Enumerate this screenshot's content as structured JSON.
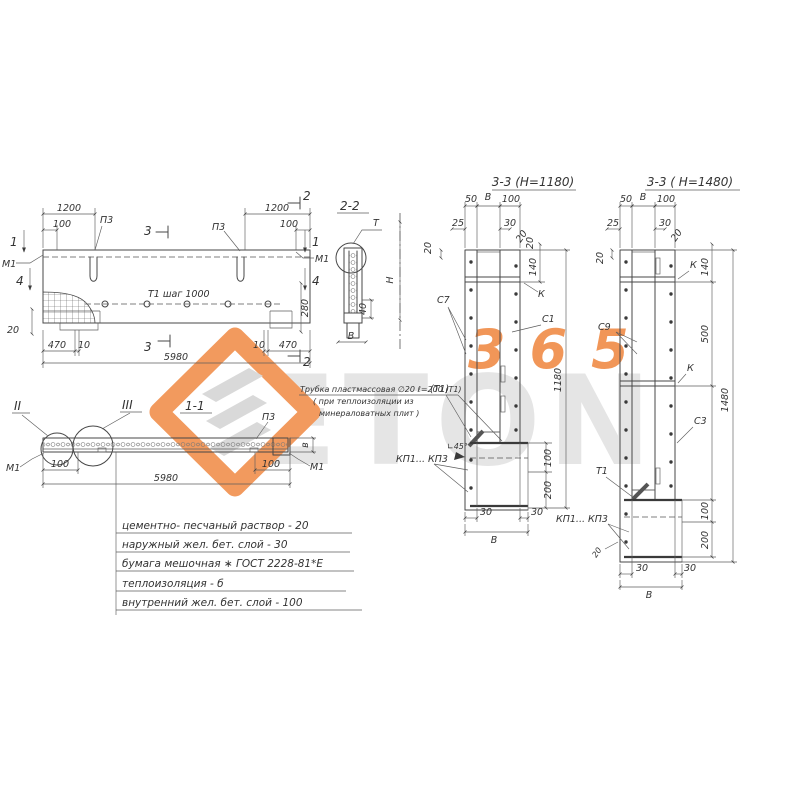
{
  "watermark": {
    "brand": "ETON",
    "number": "365",
    "accent": "#ee8034",
    "light_gray": "#e4e4e4"
  },
  "plan": {
    "dim_1200_left": "1200",
    "dim_100_left": "100",
    "label_p3_left": "П3",
    "mark_3_top": "3",
    "dim_1200_right": "1200",
    "dim_100_right": "100",
    "label_p3_right": "П3",
    "mark_2_top": "2",
    "mark_1_left": "1",
    "mark_4_left": "4",
    "label_m1_left": "М1",
    "mark_1_right": "1",
    "mark_4_right": "4",
    "label_m1_right": "М1",
    "row_note": "Т1  шаг 1000",
    "dim_20": "20",
    "dim_280": "280",
    "dim_470_left": "470",
    "dim_10_left": "10",
    "dim_10_right": "10",
    "dim_470_right": "470",
    "dim_5980": "5980",
    "mark_3_bottom": "3",
    "mark_2_bottom": "2"
  },
  "section_2_2": {
    "title": "2-2",
    "mark_t": "Т",
    "dim_h": "Н",
    "dim_40": "40",
    "dim_b": "В"
  },
  "section_1_1": {
    "title": "1-1",
    "detail_2": "II",
    "detail_3": "III",
    "label_p3": "П3",
    "label_m1_left": "М1",
    "label_m1_right": "М1",
    "dim_100_left": "100",
    "dim_100_right": "100",
    "dim_5980": "5980",
    "dim_b": "в"
  },
  "tube_note": {
    "line_1": "Трубка пластмассовая ∅20 ℓ=200 (Т1)",
    "line_2": "( при теплоизоляции из",
    "line_3": "минераловатных плит )"
  },
  "section_3_3_1180": {
    "title": "3-3 (Н=1180)",
    "dim_50": "50",
    "dim_b_top": "В",
    "dim_100_top": "100",
    "dim_25": "25",
    "dim_30_top": "30",
    "dim_20_angle": "20",
    "dim_20_left": "20",
    "dim_20_right": "20",
    "dim_140": "140",
    "label_c7": "С7",
    "label_c1": "С1",
    "label_k": "К",
    "label_t1": "(Т1)",
    "label_angle": "∟45°",
    "label_kp": "КП1... КП3",
    "dim_100_bottom": "100",
    "dim_200": "200",
    "dim_total": "1180",
    "dim_30_bl": "30",
    "dim_30_br": "30",
    "dim_b_bottom": "В"
  },
  "section_3_3_1480": {
    "title": "3-3 ( Н=1480)",
    "dim_50": "50",
    "dim_b_top": "В",
    "dim_100_top": "100",
    "dim_25": "25",
    "dim_30_top": "30",
    "dim_20_angle": "20",
    "dim_20_left": "20",
    "dim_140": "140",
    "dim_500": "500",
    "label_k1": "К",
    "label_k2": "К",
    "label_c9": "С9",
    "label_c3": "С3",
    "label_t1": "Т1",
    "label_kp": "КП1... КП3",
    "dim_20_corner": "20",
    "dim_100_bottom": "100",
    "dim_200": "200",
    "dim_total": "1480",
    "dim_30_bl": "30",
    "dim_30_br": "30",
    "dim_b_bottom": "В"
  },
  "layer_notes": {
    "lines": [
      "цементно- песчаный  раствор - 20",
      "наружный  жел. бет. слой - 30",
      "бумага  мешочная ∗ ГОСТ 2228-81*Е",
      "теплоизоляция - б",
      "внутренний жел. бет. слой - 100"
    ]
  }
}
